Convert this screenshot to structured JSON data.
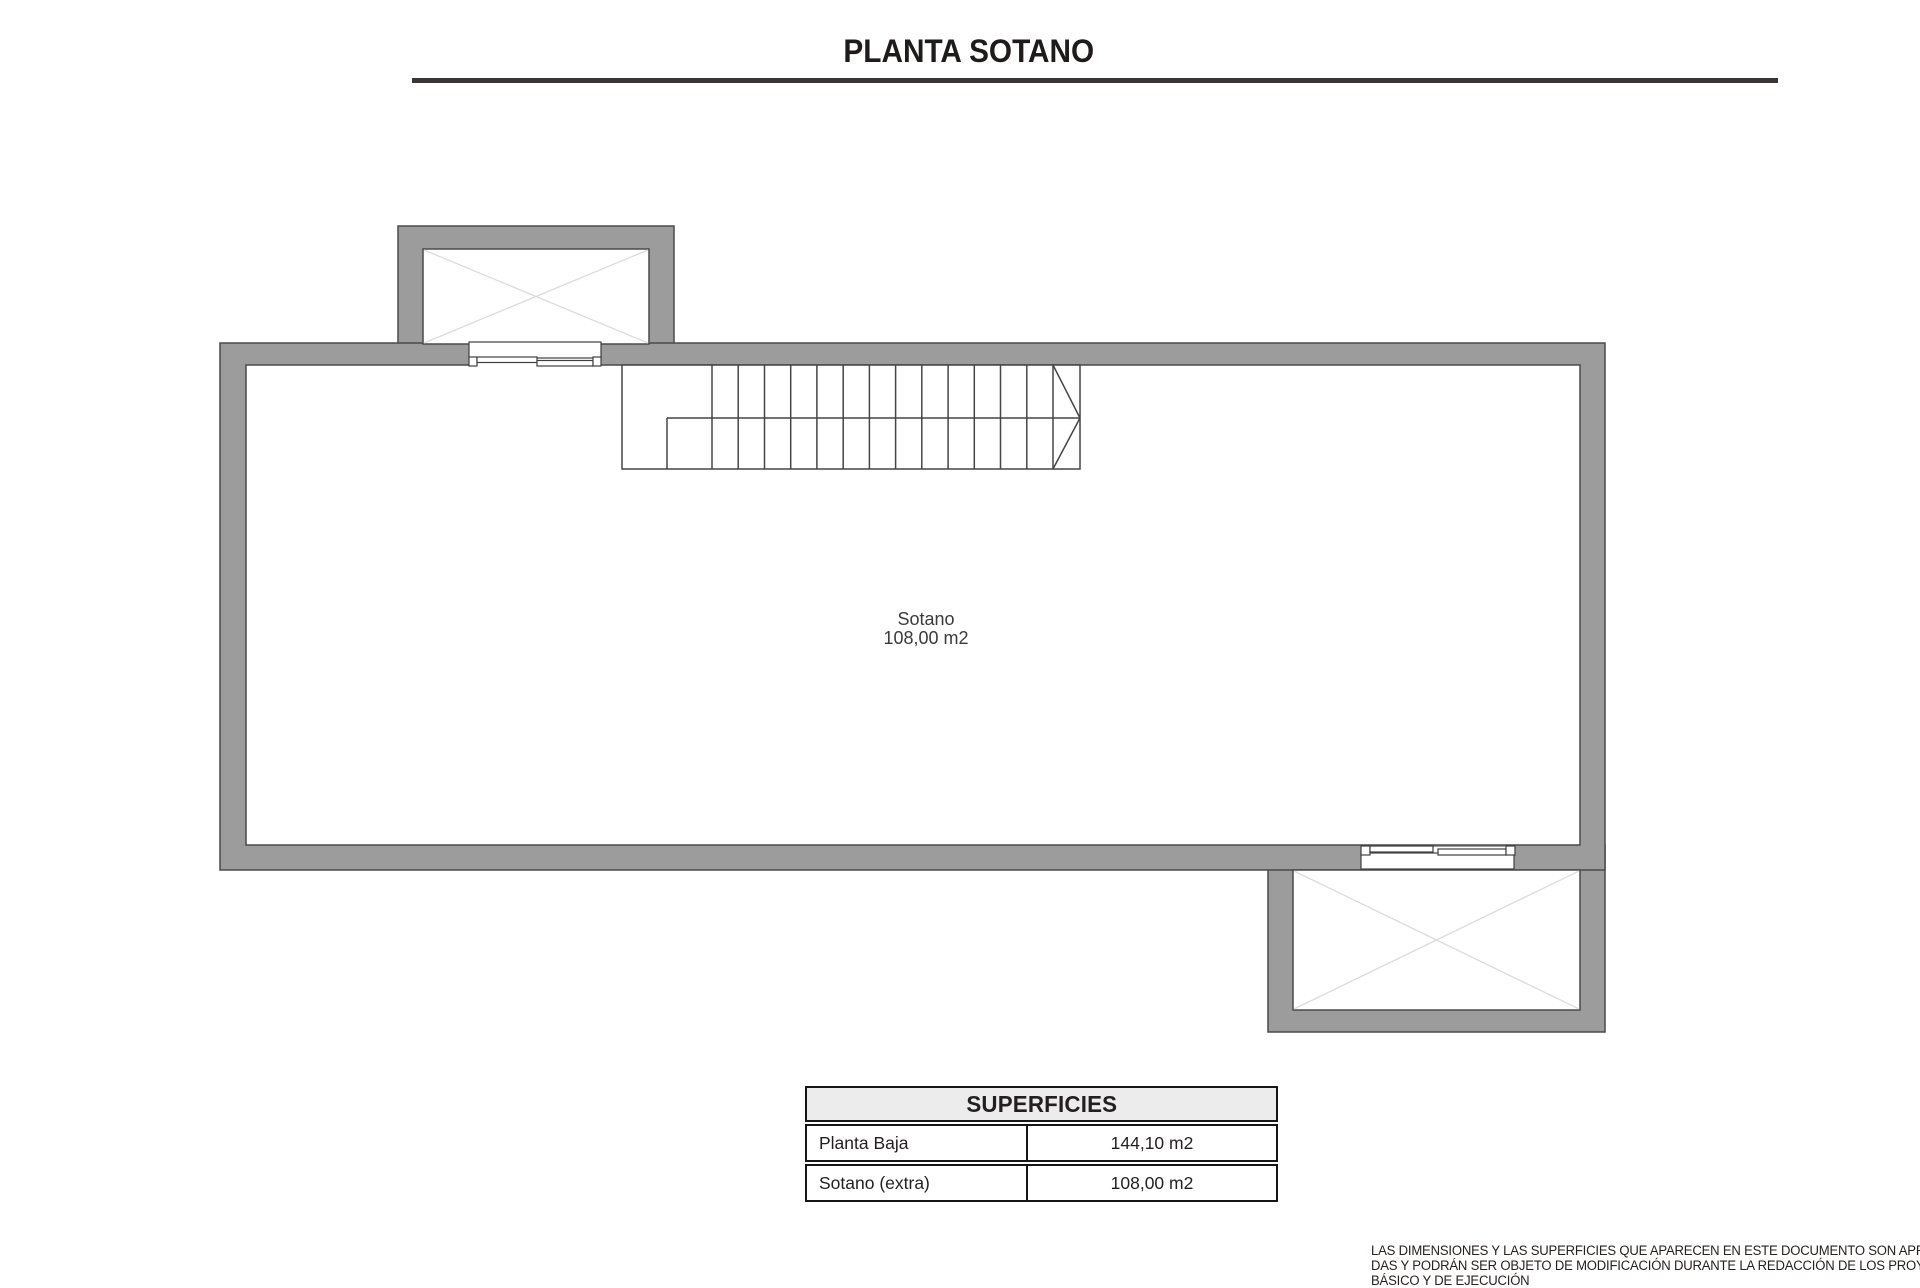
{
  "page": {
    "title": "PLANTA SOTANO"
  },
  "plan": {
    "room": {
      "name": "Sotano",
      "area": "108,00 m2"
    }
  },
  "table": {
    "title": "SUPERFICIES",
    "rows": [
      {
        "label": "Planta Baja",
        "value": "144,10 m2"
      },
      {
        "label": "Sotano (extra)",
        "value": "108,00 m2"
      }
    ]
  },
  "disclaimer": {
    "line1": "LAS DIMENSIONES Y LAS SUPERFICIES QUE APARECEN EN ESTE DOCUMENTO SON APROXIMA-",
    "line2": "DAS Y PODRÁN SER OBJETO DE MODIFICACIÓN DURANTE LA REDACCIÓN DE LOS PROYECTOS",
    "line3": "BÁSICO Y DE EJECUCIÓN"
  },
  "colors": {
    "wall_fill": "#9c9c9c",
    "wall_outline": "#4a4a4a",
    "detail_line": "#3f3f3f",
    "cross_line": "#dcdcdc",
    "table_header_bg": "#ececec",
    "table_border": "#161616",
    "title_underline": "#3b3633",
    "text": "#231f20"
  }
}
